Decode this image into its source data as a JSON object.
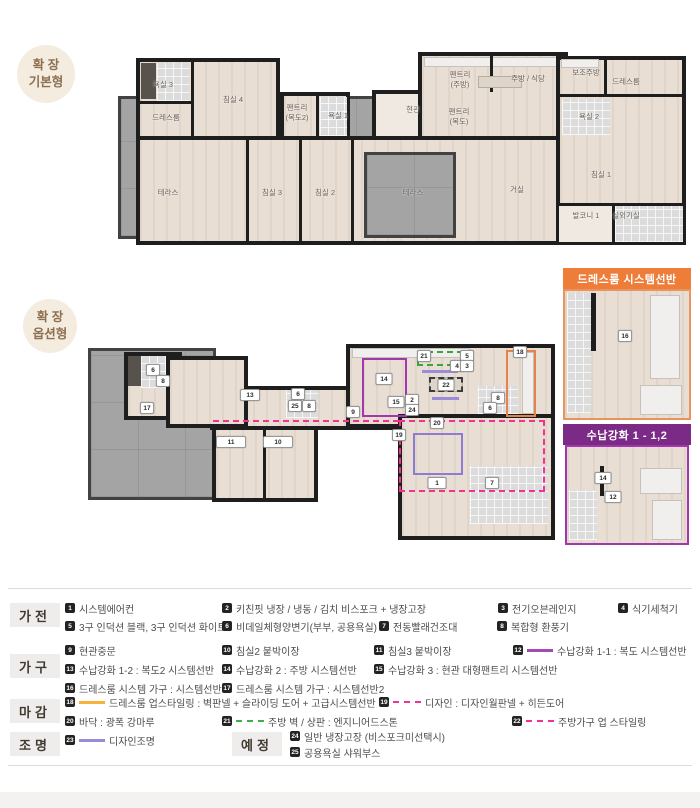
{
  "badges": {
    "basic": {
      "line1": "확 장",
      "line2": "기본형"
    },
    "option": {
      "line1": "확 장",
      "line2": "옵션형"
    }
  },
  "plan_basic": {
    "rooms": [
      {
        "t": "욕실 3",
        "x": 163,
        "y": 85
      },
      {
        "t": "침실 4",
        "x": 233,
        "y": 100
      },
      {
        "t": "드레스룸",
        "x": 166,
        "y": 118
      },
      {
        "t": "팬트리\n(복도2)",
        "x": 297,
        "y": 113
      },
      {
        "t": "욕실 1",
        "x": 338,
        "y": 116
      },
      {
        "t": "테라스",
        "x": 168,
        "y": 193
      },
      {
        "t": "침실 3",
        "x": 272,
        "y": 193
      },
      {
        "t": "침실 2",
        "x": 325,
        "y": 193
      },
      {
        "t": "테라스",
        "x": 413,
        "y": 193
      },
      {
        "t": "현관",
        "x": 413,
        "y": 110
      },
      {
        "t": "팬트리\n(주방)",
        "x": 460,
        "y": 80
      },
      {
        "t": "팬트리\n(복도)",
        "x": 459,
        "y": 117
      },
      {
        "t": "주방 / 식당",
        "x": 528,
        "y": 79
      },
      {
        "t": "보조주방",
        "x": 586,
        "y": 73
      },
      {
        "t": "드레스룸",
        "x": 626,
        "y": 82
      },
      {
        "t": "욕실 2",
        "x": 589,
        "y": 117
      },
      {
        "t": "거실",
        "x": 517,
        "y": 190
      },
      {
        "t": "침실 1",
        "x": 601,
        "y": 175
      },
      {
        "t": "발코니 1",
        "x": 586,
        "y": 216
      },
      {
        "t": "실외기실",
        "x": 626,
        "y": 216
      }
    ]
  },
  "plan_option": {
    "markers": [
      {
        "n": "6",
        "x": 153,
        "y": 370
      },
      {
        "n": "8",
        "x": 163,
        "y": 381
      },
      {
        "n": "17",
        "x": 147,
        "y": 408
      },
      {
        "n": "13",
        "x": 250,
        "y": 395,
        "w": 16
      },
      {
        "n": "6",
        "x": 298,
        "y": 394
      },
      {
        "n": "25",
        "x": 295,
        "y": 406
      },
      {
        "n": "8",
        "x": 309,
        "y": 406
      },
      {
        "n": "11",
        "x": 231,
        "y": 442,
        "w": 26
      },
      {
        "n": "10",
        "x": 278,
        "y": 442,
        "w": 26
      },
      {
        "n": "21",
        "x": 424,
        "y": 356
      },
      {
        "n": "5",
        "x": 467,
        "y": 356
      },
      {
        "n": "4",
        "x": 457,
        "y": 366
      },
      {
        "n": "3",
        "x": 467,
        "y": 366
      },
      {
        "n": "14",
        "x": 384,
        "y": 379,
        "w": 13
      },
      {
        "n": "22",
        "x": 446,
        "y": 385,
        "w": 13
      },
      {
        "n": "15",
        "x": 396,
        "y": 402,
        "w": 13
      },
      {
        "n": "2",
        "x": 412,
        "y": 400
      },
      {
        "n": "24",
        "x": 412,
        "y": 410
      },
      {
        "n": "9",
        "x": 353,
        "y": 412
      },
      {
        "n": "8",
        "x": 498,
        "y": 398
      },
      {
        "n": "6",
        "x": 490,
        "y": 408
      },
      {
        "n": "18",
        "x": 520,
        "y": 352
      },
      {
        "n": "20",
        "x": 437,
        "y": 423
      },
      {
        "n": "19",
        "x": 399,
        "y": 435
      },
      {
        "n": "1",
        "x": 437,
        "y": 483,
        "w": 15
      },
      {
        "n": "7",
        "x": 492,
        "y": 483
      }
    ]
  },
  "insets": {
    "dressroom": {
      "title": "드레스룸 시스템선반",
      "markers": [
        {
          "n": "16",
          "x": 625,
          "y": 336
        }
      ]
    },
    "storage": {
      "title": "수납강화 1 - 1,2",
      "markers": [
        {
          "n": "14",
          "x": 603,
          "y": 478,
          "w": 13
        },
        {
          "n": "12",
          "x": 613,
          "y": 497,
          "w": 13
        }
      ]
    }
  },
  "legend": {
    "sections": [
      {
        "id": "appliances",
        "label": "가전",
        "x": 10,
        "y": 603,
        "items": [
          {
            "num": "1",
            "text": "시스템에어컨",
            "x": 65,
            "y": 602
          },
          {
            "num": "2",
            "text": "키친핏 냉장 / 냉동 / 김치 비스포크 + 냉장고장",
            "x": 222,
            "y": 602
          },
          {
            "num": "3",
            "text": "전기오븐레인지",
            "x": 498,
            "y": 602
          },
          {
            "num": "4",
            "text": "식기세척기",
            "x": 618,
            "y": 602
          },
          {
            "num": "5",
            "text": "3구 인덕션 블랙, 3구 인덕션 화이트",
            "x": 65,
            "y": 620
          },
          {
            "num": "6",
            "text": "비데일체형양변기(부부, 공용욕실)",
            "x": 222,
            "y": 620
          },
          {
            "num": "7",
            "text": "전동빨래건조대",
            "x": 379,
            "y": 620
          },
          {
            "num": "8",
            "text": "복합형 환풍기",
            "x": 497,
            "y": 620
          }
        ]
      },
      {
        "id": "furniture",
        "label": "가구",
        "x": 10,
        "y": 654,
        "items": [
          {
            "num": "9",
            "text": "현관중문",
            "x": 65,
            "y": 644
          },
          {
            "num": "10",
            "text": "침실2 붙박이장",
            "x": 222,
            "y": 644
          },
          {
            "num": "11",
            "text": "침실3 붙박이장",
            "x": 374,
            "y": 644
          },
          {
            "num": "12",
            "text": "수납강화 1-1 : 복도 시스템선반",
            "x": 513,
            "y": 644,
            "swatch": "solid",
            "color": "#a348b5"
          },
          {
            "num": "13",
            "text": "수납강화 1-2 : 복도2 시스템선반",
            "x": 65,
            "y": 663
          },
          {
            "num": "14",
            "text": "수납강화 2 : 주방 시스템선반",
            "x": 222,
            "y": 663
          },
          {
            "num": "15",
            "text": "수납강화 3 : 현관 대형팬트리 시스템선반",
            "x": 374,
            "y": 663
          },
          {
            "num": "16",
            "text": "드레스룸 시스템 가구 : 시스템선반",
            "x": 65,
            "y": 682
          },
          {
            "num": "17",
            "text": "드레스룸 시스템 가구 : 시스템선반2",
            "x": 222,
            "y": 682
          }
        ]
      },
      {
        "id": "finishes",
        "label": "마감",
        "x": 10,
        "y": 699,
        "items": [
          {
            "num": "18",
            "text": "드레스룸 업스타일링 : 벽판넬 + 슬라이딩 도어 + 고급시스템선반",
            "x": 65,
            "y": 696,
            "swatch": "solid",
            "color": "#f6b33c"
          },
          {
            "num": "19",
            "text": "디자인 : 디자인월판넬 + 히든도어",
            "x": 379,
            "y": 696,
            "swatch": "dashed",
            "color": "#f5318f"
          },
          {
            "num": "20",
            "text": "바닥 : 광폭 강마루",
            "x": 65,
            "y": 715
          },
          {
            "num": "21",
            "text": "주방 벽 / 상판 : 엔지니어드스톤",
            "x": 222,
            "y": 715,
            "swatch": "dashed",
            "color": "#3fae49"
          },
          {
            "num": "22",
            "text": "주방가구 업 스타일링",
            "x": 512,
            "y": 715,
            "swatch": "dashed",
            "color": "#f5318f"
          }
        ]
      },
      {
        "id": "lighting",
        "label": "조명",
        "x": 10,
        "y": 732,
        "items": [
          {
            "num": "23",
            "text": "디자인조명",
            "x": 65,
            "y": 734,
            "swatch": "solid",
            "color": "#9b8cd9"
          }
        ]
      },
      {
        "id": "planned",
        "label": "예정",
        "x": 232,
        "y": 732,
        "items": [
          {
            "num": "24",
            "text": "일반 냉장고장 (비스포크미선택시)",
            "x": 290,
            "y": 730
          },
          {
            "num": "25",
            "text": "공용욕실 샤워부스",
            "x": 290,
            "y": 746
          }
        ]
      }
    ]
  },
  "colors": {
    "accent_orange": "#ef7d3a",
    "accent_purple": "#7b2a85",
    "pink_dashed": "#f5318f",
    "lavender_line": "#9b8cd9",
    "green_dashed": "#3fae49",
    "orange_line": "#f6b33c",
    "magenta_box": "#a335ae",
    "wall_black": "#1e1e1e",
    "floor_beige": "#e8ded4",
    "terrace_gray": "#a4a4a4"
  }
}
